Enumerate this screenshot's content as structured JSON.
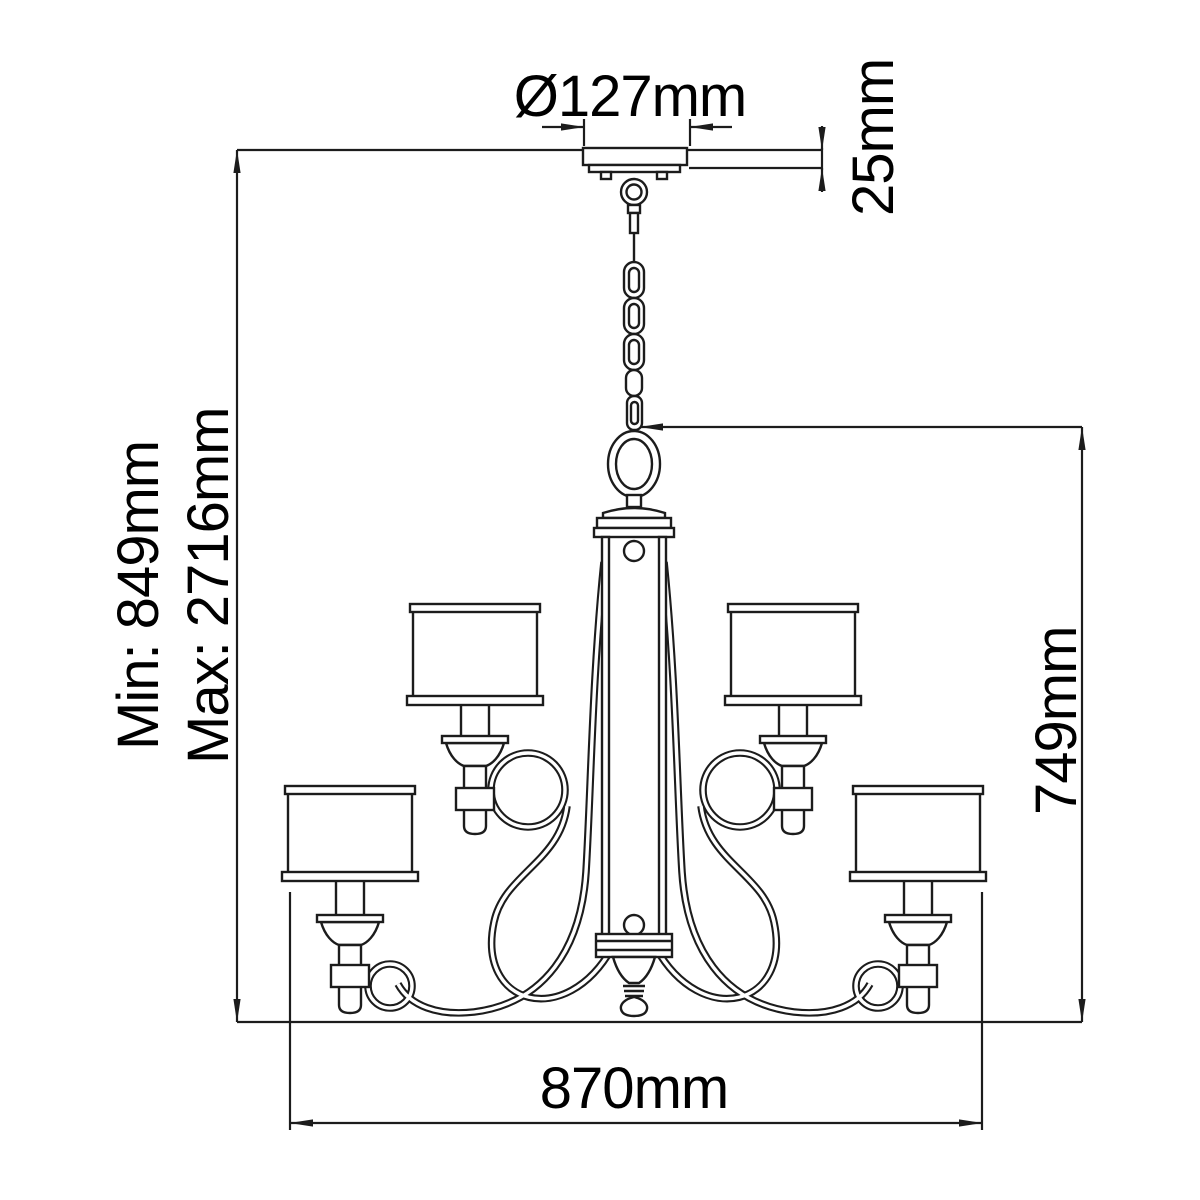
{
  "diagram": {
    "description": "Two-tier chandelier technical line drawing with dimensions",
    "dimensions": [
      {
        "id": "canopy-diameter",
        "label": "Ø127mm",
        "value": 127,
        "unit": "mm"
      },
      {
        "id": "canopy-height",
        "label": "25mm",
        "value": 25,
        "unit": "mm"
      },
      {
        "id": "min-drop",
        "label": "Min: 849mm",
        "value": 849,
        "unit": "mm"
      },
      {
        "id": "max-drop",
        "label": "Max: 2716mm",
        "value": 2716,
        "unit": "mm"
      },
      {
        "id": "body-height",
        "label": "749mm",
        "value": 749,
        "unit": "mm"
      },
      {
        "id": "overall-width",
        "label": "870mm",
        "value": 870,
        "unit": "mm"
      }
    ],
    "colors": {
      "line": "#1c1c1c",
      "background": "#ffffff",
      "text": "#000000"
    }
  }
}
